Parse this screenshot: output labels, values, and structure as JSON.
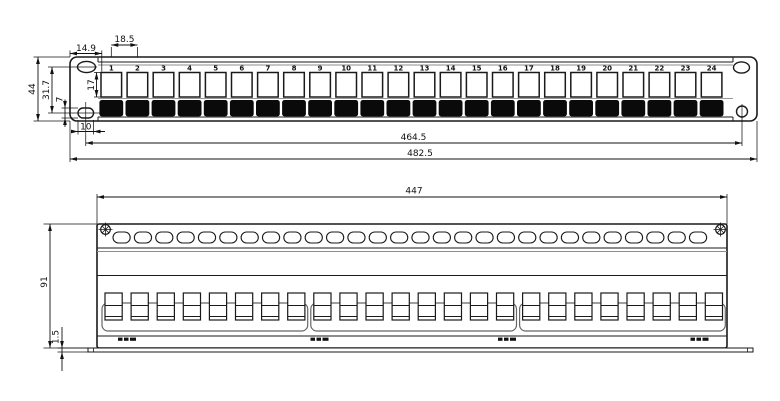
{
  "front": {
    "port_labels": [
      "1",
      "2",
      "3",
      "4",
      "5",
      "6",
      "7",
      "8",
      "9",
      "10",
      "11",
      "12",
      "13",
      "14",
      "15",
      "16",
      "17",
      "18",
      "19",
      "20",
      "21",
      "22",
      "23",
      "24"
    ],
    "dims": {
      "pitch": "18.5",
      "edge_offset": "14.9",
      "port_height": "17",
      "panel_height": "44",
      "hole_offset": "31.7",
      "slot_height": "7",
      "slot_width": "10",
      "hole_span": "464.5",
      "overall_width": "482.5"
    }
  },
  "rear": {
    "dims": {
      "body_width": "447",
      "body_height": "91",
      "flange_thickness": "1.5"
    },
    "vent_slot_count": 28,
    "keystone_count": 24,
    "keystone_groups": 3,
    "keystones_per_group": 8,
    "foot_mark_count": 4
  },
  "colors": {
    "line": "#1a1a1a",
    "secondary": "#8c8c8c",
    "connector_fill": "#0a0a0a",
    "background": "#ffffff"
  }
}
